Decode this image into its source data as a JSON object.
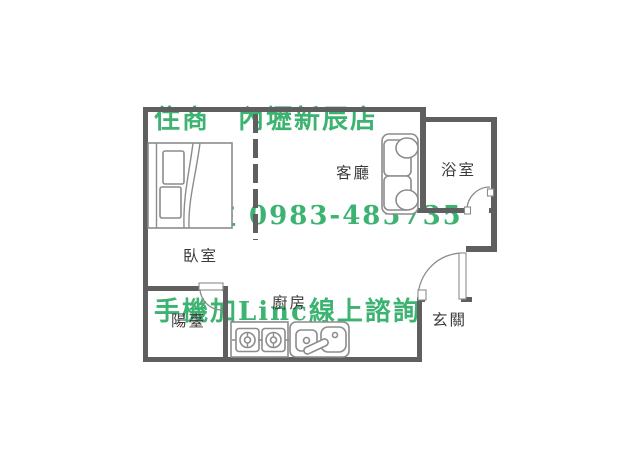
{
  "header": {
    "line1": "住商　內壢新辰店",
    "line2": "楊先生 0983-485735",
    "line3": "手機加Linc線上諮詢"
  },
  "floorplan": {
    "rooms": {
      "bedroom": "臥室",
      "living_room": "客廳",
      "bathroom": "浴室",
      "kitchen": "廚房",
      "entrance": "玄關",
      "balcony": "陽臺"
    },
    "icons": [
      "bed-icon",
      "sofa-icon",
      "stove-icon",
      "sink-icon",
      "door-swing-icon",
      "dashed-partition"
    ]
  },
  "colors": {
    "text_green": "#3cb371",
    "wall_gray": "#5f5f5f",
    "furniture_gray": "#8c8c8c",
    "label_gray": "#3a3a3a",
    "background": "#ffffff"
  }
}
